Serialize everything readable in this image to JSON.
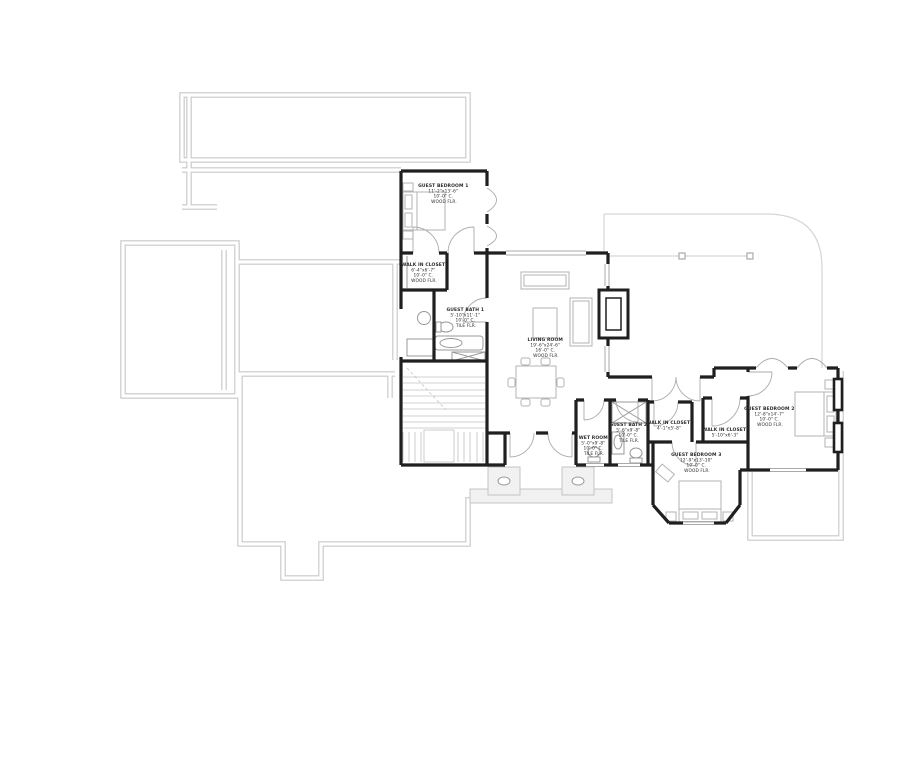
{
  "page": {
    "background": "#ffffff",
    "type": "architectural-floor-plan"
  },
  "plan": {
    "wall_color": "#1f1f1f",
    "lower_level_line_color": "#c9c9c9",
    "fixture_line_color": "#9a9a9a",
    "rooms": [
      {
        "id": "guest-bedroom-1",
        "name": "GUEST BEDROOM 1",
        "size": "11'-2\"x13'-6\"",
        "ceiling": "10'-0\" C.",
        "floor": "WOOD FLR."
      },
      {
        "id": "walk-in-closet-1",
        "name": "WALK IN CLOSET",
        "size": "6'-4\"x6'-7\"",
        "ceiling": "10'-0\" C.",
        "floor": "WOOD FLR."
      },
      {
        "id": "guest-bath-1",
        "name": "GUEST BATH 1",
        "size": "5'-10\"x11'-1\"",
        "ceiling": "10'-0\" C.",
        "floor": "TILE FLR."
      },
      {
        "id": "living-room",
        "name": "LIVING ROOM",
        "size": "19'-6\"x24'-6\"",
        "ceiling": "16'-0\" C.",
        "floor": "WOOD FLR."
      },
      {
        "id": "wet-room",
        "name": "WET ROOM",
        "size": "5'-0\"x9'-8\"",
        "ceiling": "10'-0\" C.",
        "floor": "TILE FLR."
      },
      {
        "id": "guest-bath-2",
        "name": "GUEST BATH 2",
        "size": "5'-6\"x9'-8\"",
        "ceiling": "10'-0\" C.",
        "floor": "TILE FLR."
      },
      {
        "id": "walk-in-closet-2",
        "name": "WALK IN CLOSET",
        "size": "4'-1\"x5'-8\""
      },
      {
        "id": "walk-in-closet-3",
        "name": "WALK IN CLOSET",
        "size": "5'-10\"x6'-3\""
      },
      {
        "id": "guest-bedroom-2",
        "name": "GUEST BEDROOM 2",
        "size": "12'-8\"x14'-7\"",
        "ceiling": "10'-0\" C.",
        "floor": "WOOD FLR."
      },
      {
        "id": "guest-bedroom-3",
        "name": "GUEST BEDROOM 3",
        "size": "12'-9\"x13'-10\"",
        "ceiling": "10'-0\" C.",
        "floor": "WOOD FLR."
      }
    ]
  }
}
